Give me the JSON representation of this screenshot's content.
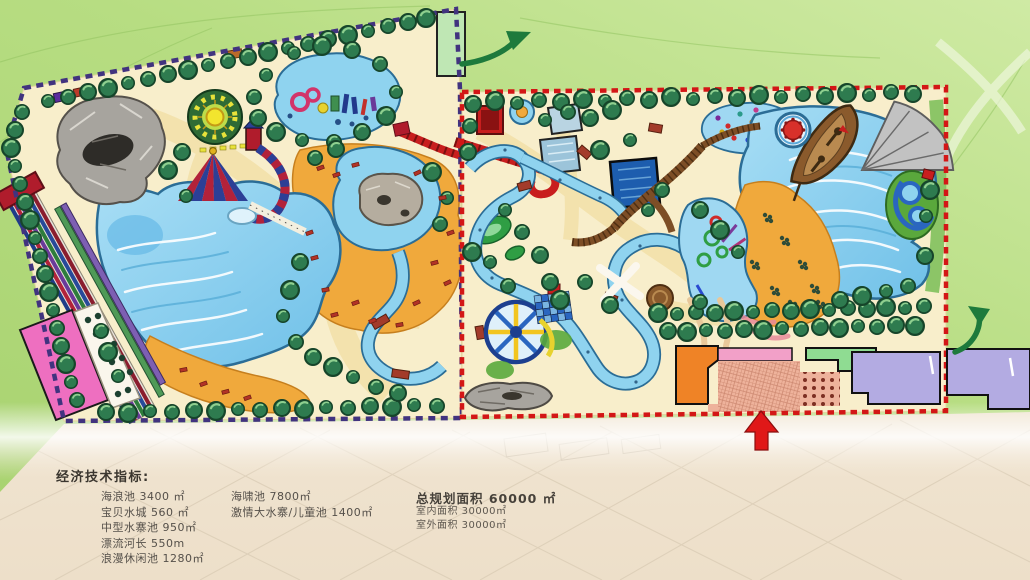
{
  "indicators": {
    "title": "经济技术指标:",
    "column1": [
      "海浪池 3400 ㎡",
      "宝贝水城 560 ㎡",
      "中型水寨池  950㎡",
      "漂流河长  550m",
      "浪漫休闲池  1280㎡"
    ],
    "column2": [
      "海啸池  7800㎡",
      "激情大水寨/儿童池  1400㎡"
    ],
    "total": {
      "headline": "总规划面积 60000 ㎡",
      "sub": [
        "室内面积 30000㎡",
        "室外面积 30000㎡"
      ]
    }
  },
  "map": {
    "zones": [
      {
        "name": "west-outdoor-park",
        "boundary_color": "#41337f",
        "boundary_style": "dashed"
      },
      {
        "name": "east-outdoor-park",
        "boundary_color": "#d31616",
        "boundary_style": "dashed"
      }
    ],
    "icons": [
      "pirate-ship",
      "wave-pool",
      "tsunami-pool",
      "lazy-river",
      "racing-slides",
      "sunflower-ride",
      "tent-slide",
      "kids-pool",
      "ferris-water-wheel",
      "entrance-arrow-icon",
      "direction-arrow-icon"
    ],
    "palette": {
      "field_green": "#b7dd82",
      "paper_beige": "#f2e6d4",
      "park_ground": "#f8eecb",
      "water": "#8fd3ef",
      "beach_orange": "#f0a93c",
      "tree_green": "#2e7b4f",
      "west_boundary": "#41337f",
      "east_boundary": "#d31616",
      "entrance_red": "#e01818"
    }
  }
}
